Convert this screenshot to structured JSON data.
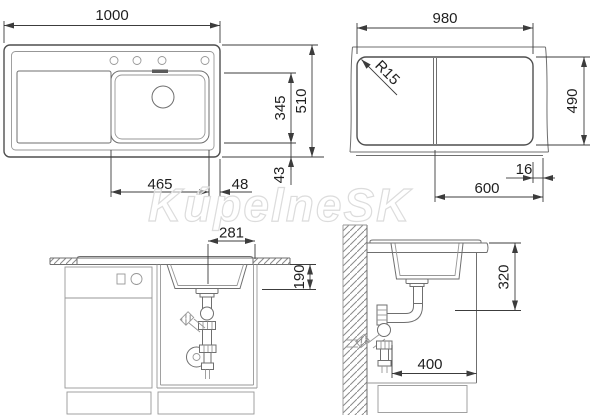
{
  "watermark": "KúpelneSK",
  "colors": {
    "line": "#6f6f6f",
    "dimension_line": "#3c3c3c",
    "text": "#1f1f1f",
    "watermark_stroke": "#dcdcdc",
    "background": "#ffffff"
  },
  "views": {
    "top": {
      "total_width": "1000",
      "bowl_width": "465",
      "edge_offset": "48",
      "total_depth": "510",
      "bowl_depth": "345",
      "bottom_offset": "43"
    },
    "cutout": {
      "width": "980",
      "corner_radius": "R15",
      "depth": "490",
      "bowl_zone": "600",
      "edge_offset": "16"
    },
    "front": {
      "drain_to_edge": "281",
      "bowl_height": "190"
    },
    "side": {
      "height_clearance": "320",
      "depth_clearance": "400"
    }
  }
}
